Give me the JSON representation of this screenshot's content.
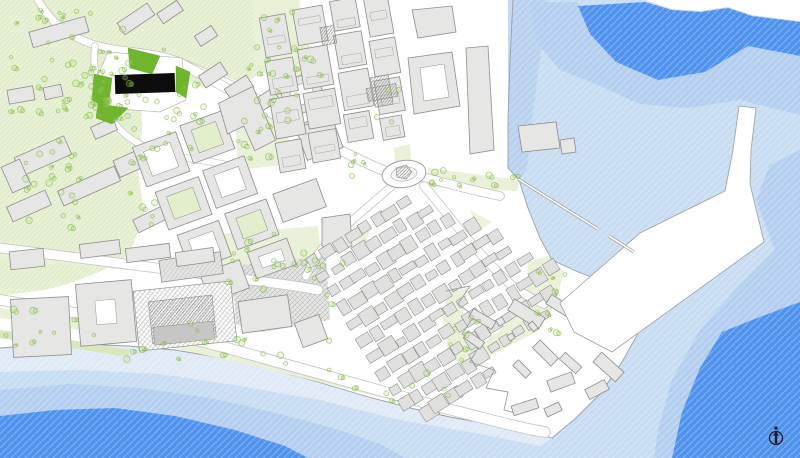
{
  "map": {
    "compass": {
      "icon": "north-arrow-icon",
      "direction": "N"
    },
    "colors": {
      "water_deep": "#4f93ee",
      "water_mid": "#b3ceee",
      "water_light": "#c8dcf2",
      "water_shallow": "#dfeaf6",
      "coastline": "#98a0a4",
      "land": "#ffffff",
      "green_field": "#e9f1d8",
      "green_shade": "#d9e8bc",
      "green_bright": "#6fb62c",
      "green_court": "#e3eecb",
      "tree_stroke": "#7ab335",
      "tree_fill": "#b9d98a",
      "building_fill": "#e6e6e4",
      "building_stroke": "#8c8c8a",
      "building_dark": "#c6c6c4",
      "road_casing": "#c3c3c1",
      "highlight_building": "#0d0d0d",
      "compass": "#1a1a1a"
    },
    "layers": [
      "open-sea",
      "harbor-basin",
      "breakwater-quay",
      "marina-piers",
      "beach-shoreline",
      "green-hillside",
      "parks",
      "street-trees",
      "city-blocks",
      "old-town",
      "industrial-waterfront",
      "citadel-peninsula",
      "highlighted-building",
      "roundabout",
      "roads"
    ]
  }
}
